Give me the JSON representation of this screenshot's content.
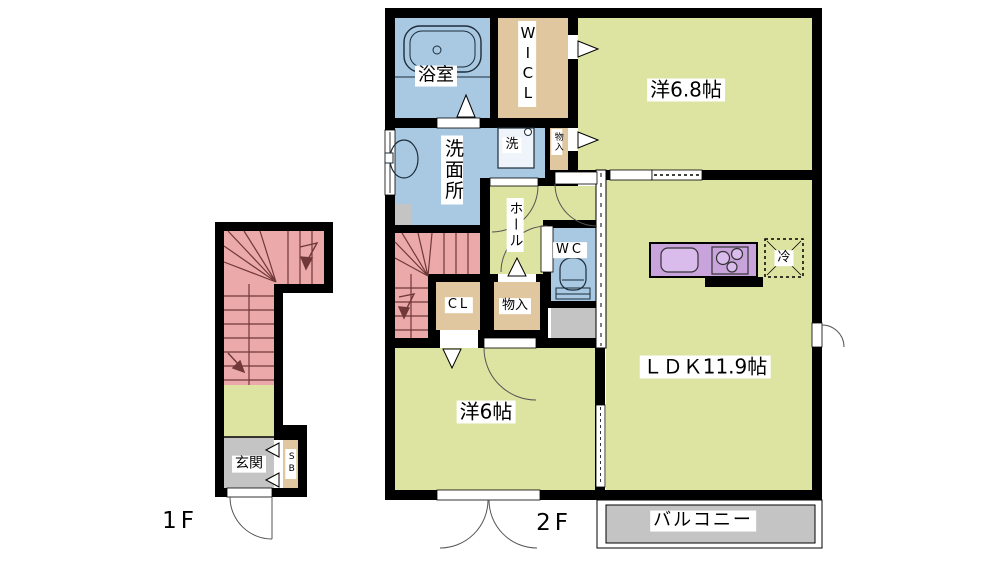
{
  "colors": {
    "wall": "#000000",
    "room_yellow": "#dde3a0",
    "wet_area_blue": "#a9c9e2",
    "closet_tan": "#e0c79f",
    "stairs_pink": "#eba9a9",
    "concrete_gray": "#c4c4c4",
    "kitchen_purple": "#c9a3dc",
    "kitchen_fixture_purple": "#d9bceb",
    "stair_line": "#703838",
    "label_bg": "#ffffff"
  },
  "floor1": {
    "label": "1F",
    "genkan": "玄関",
    "shoe_box": "SB"
  },
  "floor2": {
    "label": "2F",
    "bath": "浴室",
    "walk_in_closet": "WICL",
    "washroom": "洗面所",
    "washing_machine": "洗",
    "storage_upper": "物入",
    "bedroom_6_8": "洋6.8帖",
    "hall": "ホール",
    "toilet": "WC",
    "closet": "CL",
    "storage_lower": "物入",
    "bedroom_6": "洋6帖",
    "ldk": "ＬＤＫ11.9帖",
    "refrigerator": "冷",
    "balcony": "バルコニー"
  }
}
